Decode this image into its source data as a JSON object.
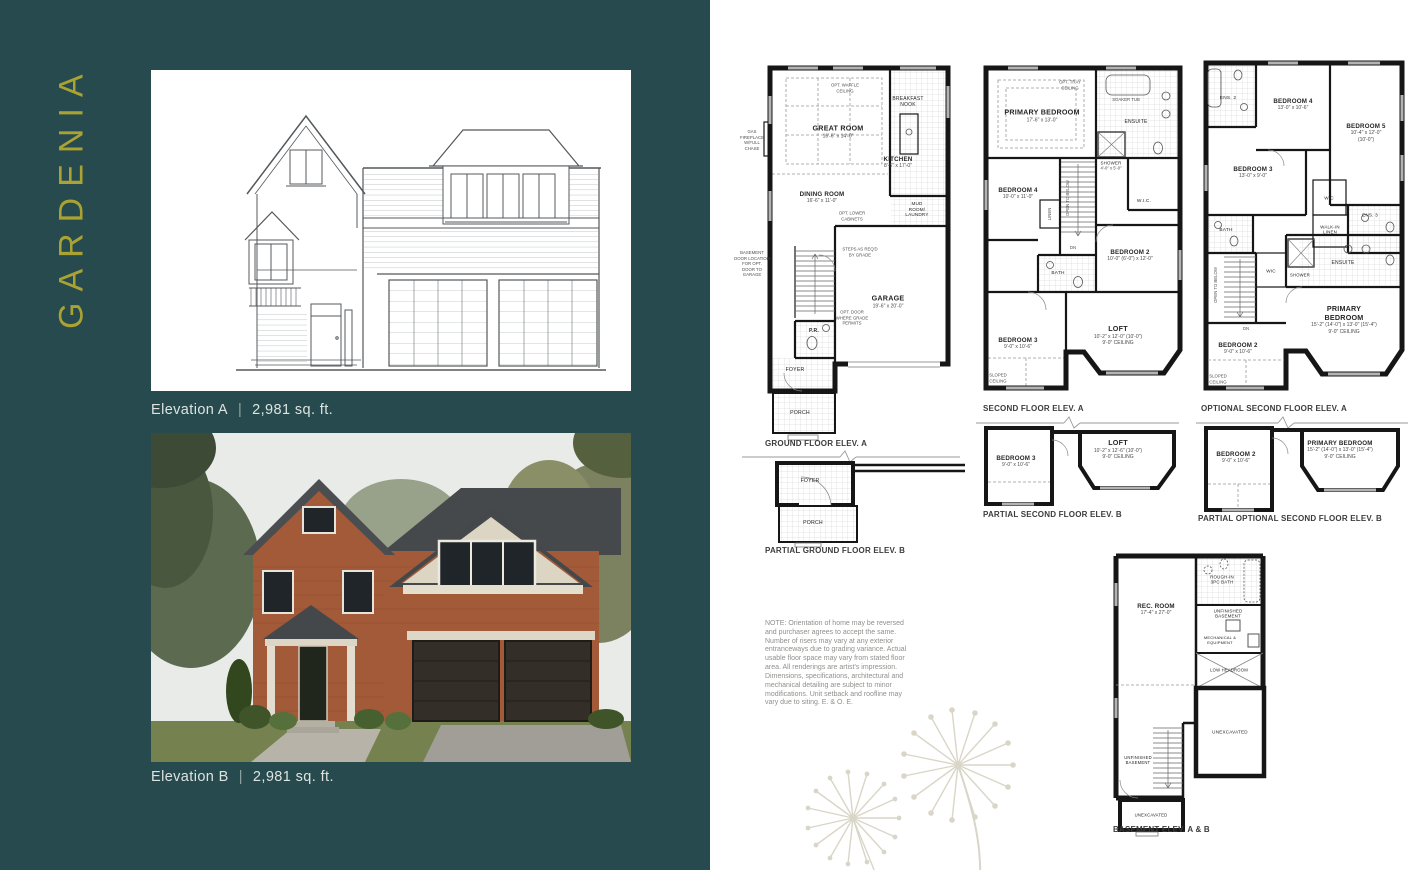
{
  "left": {
    "title": "GARDENIA",
    "elevation_a": {
      "label": "Elevation A",
      "sep": "|",
      "sqft": "2,981 sq. ft."
    },
    "elevation_b": {
      "label": "Elevation B",
      "sep": "|",
      "sqft": "2,981 sq. ft."
    }
  },
  "note": {
    "text": "NOTE: Orientation of home may be reversed and purchaser agrees to accept the same. Number of risers may vary at any exterior entranceways due to grading variance. Actual usable floor space may vary from stated floor area. All renderings are artist's impression. Dimensions, specifications, architectural and mechanical detailing are subject to minor modifications. Unit setback and roofline may vary due to siting. E. & O. E."
  },
  "plans": {
    "ground_a": {
      "caption": "GROUND FLOOR ELEV. A",
      "rooms": {
        "great_room": {
          "name": "GREAT ROOM",
          "dims": "16'-6\" x 14'-0\""
        },
        "dining_room": {
          "name": "DINING ROOM",
          "dims": "16'-6\" x 11'-0\""
        },
        "kitchen": {
          "name": "KITCHEN",
          "dims": "8'-6\" x 17'-0\""
        },
        "breakfast_nook": {
          "name": "BREAKFAST\nNOOK"
        },
        "mud_room": {
          "name": "MUD\nROOM/\nLAUNDRY"
        },
        "garage": {
          "name": "GARAGE",
          "dims": "19'-6\" x 20'-0\""
        },
        "pr": {
          "name": "P.R."
        },
        "foyer": {
          "name": "FOYER"
        },
        "porch": {
          "name": "PORCH"
        }
      },
      "notes": {
        "waffle": "OPT. WAFFLE\nCEILING",
        "fireplace": "GAS\nFIREPLACE\nW/FULL\nCHASE",
        "cabinets": "OPT. LOWER\nCABINETS",
        "opt_door": "OPT. DOOR\nWHERE GRADE\nPERMITS",
        "steps": "STEPS AS REQ'D\nBY GRADE",
        "bsmt_door": "BASEMENT\nDOOR LOCATION\nFOR OPT.\nDOOR TO\nGARAGE"
      }
    },
    "second_a": {
      "caption": "SECOND FLOOR ELEV. A",
      "rooms": {
        "primary": {
          "name": "PRIMARY BEDROOM",
          "dims": "17'-6\" x 13'-0\""
        },
        "ensuite": {
          "name": "ENSUITE"
        },
        "soaker": {
          "name": "SOAKER TUB"
        },
        "shower": {
          "name": "SHOWER",
          "dims": "4'-0\" x 5'-0\""
        },
        "wic": {
          "name": "W.I.C."
        },
        "bedroom4": {
          "name": "BEDROOM 4",
          "dims": "10'-0\" x 11'-0\""
        },
        "linen": {
          "name": "LINEN"
        },
        "bedroom2": {
          "name": "BEDROOM 2",
          "dims": "10'-0\" (6'-0\") x 12'-0\""
        },
        "bath": {
          "name": "BATH"
        },
        "bedroom3": {
          "name": "BEDROOM 3",
          "dims": "9'-0\" x 10'-6\""
        },
        "loft": {
          "name": "LOFT",
          "dims": "10'-2\" x 12'-0\" (10'-0\")",
          "ceiling": "9'-0\" CEILING"
        }
      },
      "notes": {
        "tray": "OPT. TRAY\nCEILING",
        "open_below": "OPEN TO BELOW",
        "sloped": "SLOPED\nCEILING",
        "dn": "DN"
      }
    },
    "optional_a": {
      "caption": "OPTIONAL SECOND  FLOOR ELEV. A",
      "rooms": {
        "bedroom4": {
          "name": "BEDROOM 4",
          "dims": "13'-0\" x 10'-6\""
        },
        "bedroom5": {
          "name": "BEDROOM 5",
          "dims": "10'-4\" x 12'-0\" (10'-0\")"
        },
        "bedroom3": {
          "name": "BEDROOM 3",
          "dims": "13'-0\" x 9'-0\""
        },
        "ens2": {
          "name": "ENS. 2"
        },
        "ens3": {
          "name": "ENS. 3"
        },
        "bath": {
          "name": "BATH"
        },
        "wic": {
          "name": "WIC"
        },
        "wic2": {
          "name": "WIC"
        },
        "walkin_linen": {
          "name": "WALK-IN\nLINEN"
        },
        "shower": {
          "name": "SHOWER"
        },
        "ensuite": {
          "name": "ENSUITE"
        },
        "primary": {
          "name": "PRIMARY BEDROOM",
          "dims": "15'-2\" (14'-0\") x 13'-0\" (15'-4\")",
          "ceiling": "9'-0\" CEILING"
        },
        "bedroom2": {
          "name": "BEDROOM 2",
          "dims": "9'-0\" x 10'-6\""
        }
      },
      "notes": {
        "open_below": "OPEN TO BELOW",
        "sloped": "SLOPED\nCEILING",
        "dn": "DN"
      }
    },
    "partial_ground_b": {
      "caption": "PARTIAL GROUND FLOOR ELEV. B",
      "rooms": {
        "foyer": {
          "name": "FOYER"
        },
        "porch": {
          "name": "PORCH"
        }
      }
    },
    "partial_second_b": {
      "caption": "PARTIAL SECOND FLOOR ELEV. B",
      "rooms": {
        "bedroom3": {
          "name": "BEDROOM 3",
          "dims": "9'-0\" x 10'-6\""
        },
        "loft": {
          "name": "LOFT",
          "dims": "10'-2\" x 12'-6\" (10'-0\")",
          "ceiling": "9'-0\" CEILING"
        }
      }
    },
    "partial_optional_b": {
      "caption": "PARTIAL OPTIONAL  SECOND FLOOR ELEV. B",
      "rooms": {
        "bedroom2": {
          "name": "BEDROOM 2",
          "dims": "9'-0\" x 10'-6\""
        },
        "primary": {
          "name": "PRIMARY BEDROOM",
          "dims": "15'-2\" (14'-0\") x 13'-0\" (15'-4\")",
          "ceiling": "9'-0\" CEILING"
        }
      }
    },
    "basement": {
      "caption": "BASEMENT ELEV. A & B",
      "rooms": {
        "rec": {
          "name": "REC. ROOM",
          "dims": "17'-4\" x 27'-0\""
        },
        "roughin": {
          "name": "ROUGH-IN\n3PC BATH"
        },
        "unfinished": {
          "name": "UNFINISHED\nBASEMENT"
        },
        "mech": {
          "name": "MECHANICAL &\nEQUIPMENT"
        },
        "low": {
          "name": "LOW HEADROOM"
        },
        "unexcavated": {
          "name": "UNEXCAVATED"
        },
        "unfinished2": {
          "name": "UNFINISHED\nBASEMENT"
        },
        "unexcavated2": {
          "name": "UNEXCAVATED"
        }
      }
    }
  },
  "colors": {
    "teal": "#264a4d",
    "gold": "#aaa233",
    "caption": "#dde3e0",
    "plan_ink": "#161616"
  }
}
